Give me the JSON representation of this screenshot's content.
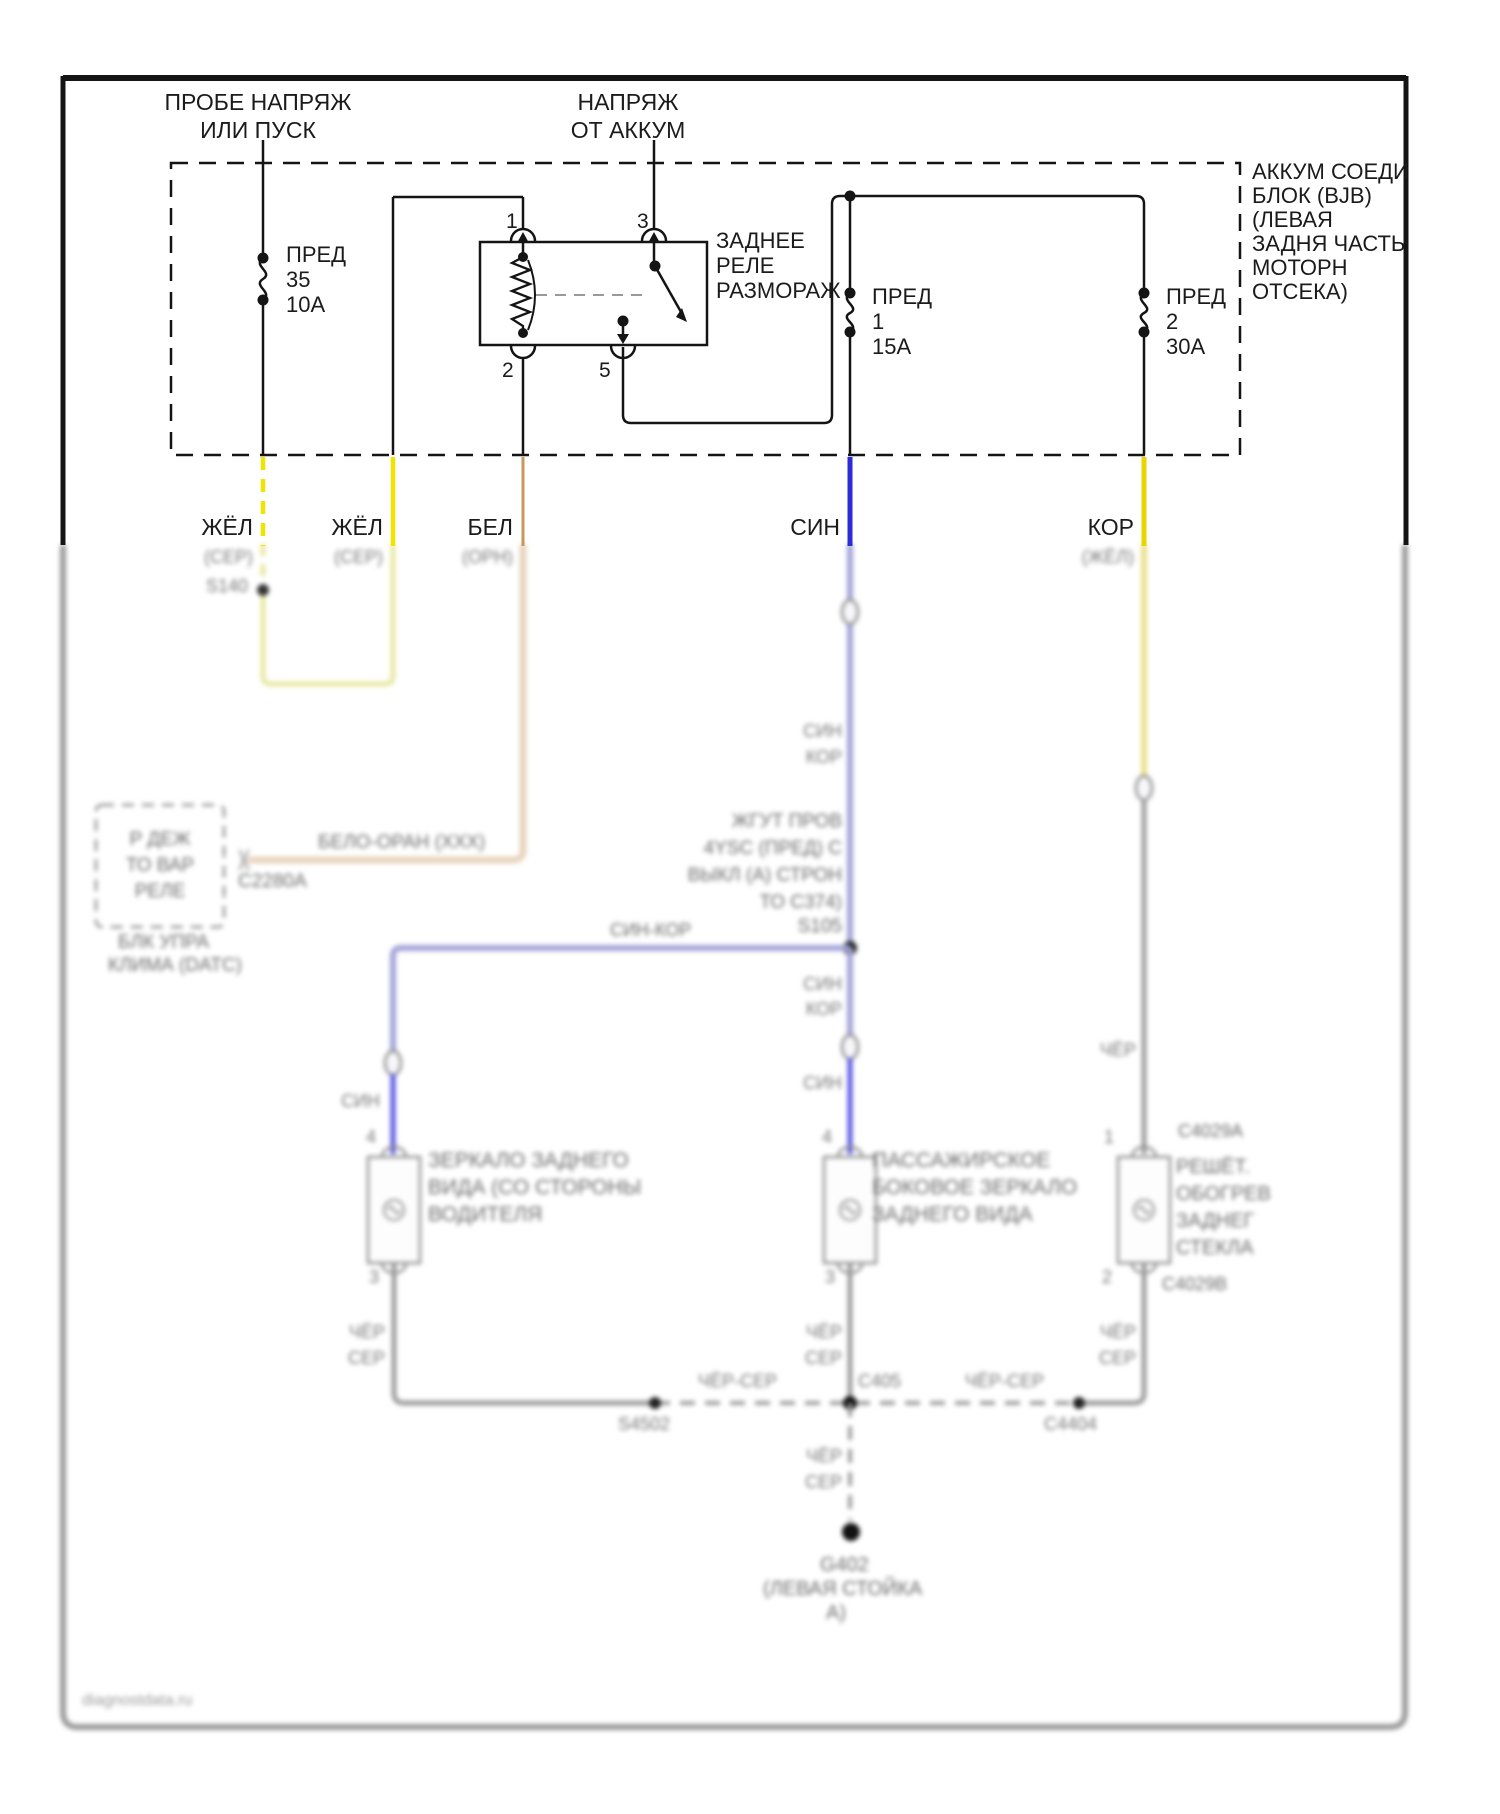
{
  "colors": {
    "ink": "#141414",
    "yellow": "#f0e400",
    "pale_yellow": "#e7e7a2",
    "tan": "#c9965c",
    "pale_tan": "#e8d5be",
    "blue": "#2b2bd8",
    "lavender": "#a2a2d8",
    "blue_bright": "#5555e2",
    "kor_yellow": "#e8d600",
    "pale_kor": "#e9e18c",
    "gray_wire": "#9b9b9b",
    "border_gray": "#9a9a9a"
  },
  "header": {
    "probe_line1": "ПРОБЕ НАПРЯЖ",
    "probe_line2": "ИЛИ ПУСК",
    "batt_line1": "НАПРЯЖ",
    "batt_line2": "ОТ АККУМ"
  },
  "bjb": {
    "label_lines": [
      "АККУМ СОЕДИ",
      "БЛОК (BJB)",
      "(ЛЕВАЯ",
      "ЗАДНЯ ЧАСТЬ",
      "МОТОРН",
      "ОТСЕКА)"
    ],
    "fuse_35": {
      "name": "ПРЕД",
      "num": "35",
      "amp": "10А"
    },
    "fuse_1": {
      "name": "ПРЕД",
      "num": "1",
      "amp": "15А"
    },
    "fuse_2": {
      "name": "ПРЕД",
      "num": "2",
      "amp": "30А"
    }
  },
  "relay": {
    "line1": "ЗАДНЕЕ",
    "line2": "РЕЛЕ",
    "line3": "РАЗМОРАЖ",
    "pin1": "1",
    "pin2": "2",
    "pin3": "3",
    "pin5": "5"
  },
  "wires": {
    "w1": "ЖЁЛ",
    "w2": "ЖЁЛ",
    "w3": "БЕЛ",
    "w4": "СИН",
    "w5": "КОР"
  },
  "blur": {
    "w1_sub": "(СЕР)",
    "w1_splice": "S140",
    "w2_sub": "(СЕР)",
    "w3_sub": "(ОРН)",
    "w5_sub": "(ЖЁЛ)",
    "tan_wire_label": "БЕЛО-ОРАН (ХХХ)",
    "tan_conn": "С2280А",
    "relay_box_lines": [
      "Р ДЕЖ",
      "ТО ВАР",
      "РЕЛЕ"
    ],
    "relay_box_sub": [
      "БЛК УПРА",
      "КЛИМА (DATC)"
    ],
    "branch_wire": "СИН-КОР",
    "harness_note": [
      "ЖГУТ ПРОВ",
      "4YSC (ПРЕД) С",
      "ВЫКЛ (А) СТРОН",
      "ТО С374)",
      "S105"
    ],
    "sin_pair1": [
      "СИН",
      "КОР"
    ],
    "sin_pair2": [
      "СИН",
      "КОР"
    ],
    "sin_single": "СИН",
    "branch_sin": "СИН",
    "kor_black": "ЧЁР",
    "left_mirror": [
      "ЗЕРКАЛО ЗАДНЕГО",
      "ВИДА (СО СТОРОНЫ",
      "ВОДИТЕЛЯ"
    ],
    "mid_mirror": [
      "ПАССАЖИРСКОЕ",
      "БОКОВОЕ ЗЕРКАЛО",
      "ЗАДНЕГО ВИДА"
    ],
    "right_comp": [
      "РЕШЁТ.",
      "ОБОГРЕВ",
      "ЗАДНЕГ",
      "СТЕКЛА"
    ],
    "right_conn_top": "С4029А",
    "right_conn_bot": "С4029В",
    "pins": {
      "left_top": "4",
      "left_bot": "3",
      "mid_top": "4",
      "mid_bot": "3",
      "right_top": "1",
      "right_bot": "2"
    },
    "gnd_left": [
      "ЧЁР",
      "СЕР"
    ],
    "gnd_mid": [
      "ЧЁР",
      "СЕР"
    ],
    "gnd_right": [
      "ЧЁР",
      "СЕР"
    ],
    "gnd_mid2": [
      "ЧЁР",
      "СЕР"
    ],
    "bus_left": "ЧЁР-СЕР",
    "bus_right": "ЧЁР-СЕР",
    "center_conn": "С405",
    "splice_left": "S4502",
    "splice_right": "С4404",
    "ground": [
      "G402",
      "(ЛЕВАЯ СТОЙКА",
      "А)"
    ]
  },
  "watermark": "diagnostdata.ru"
}
